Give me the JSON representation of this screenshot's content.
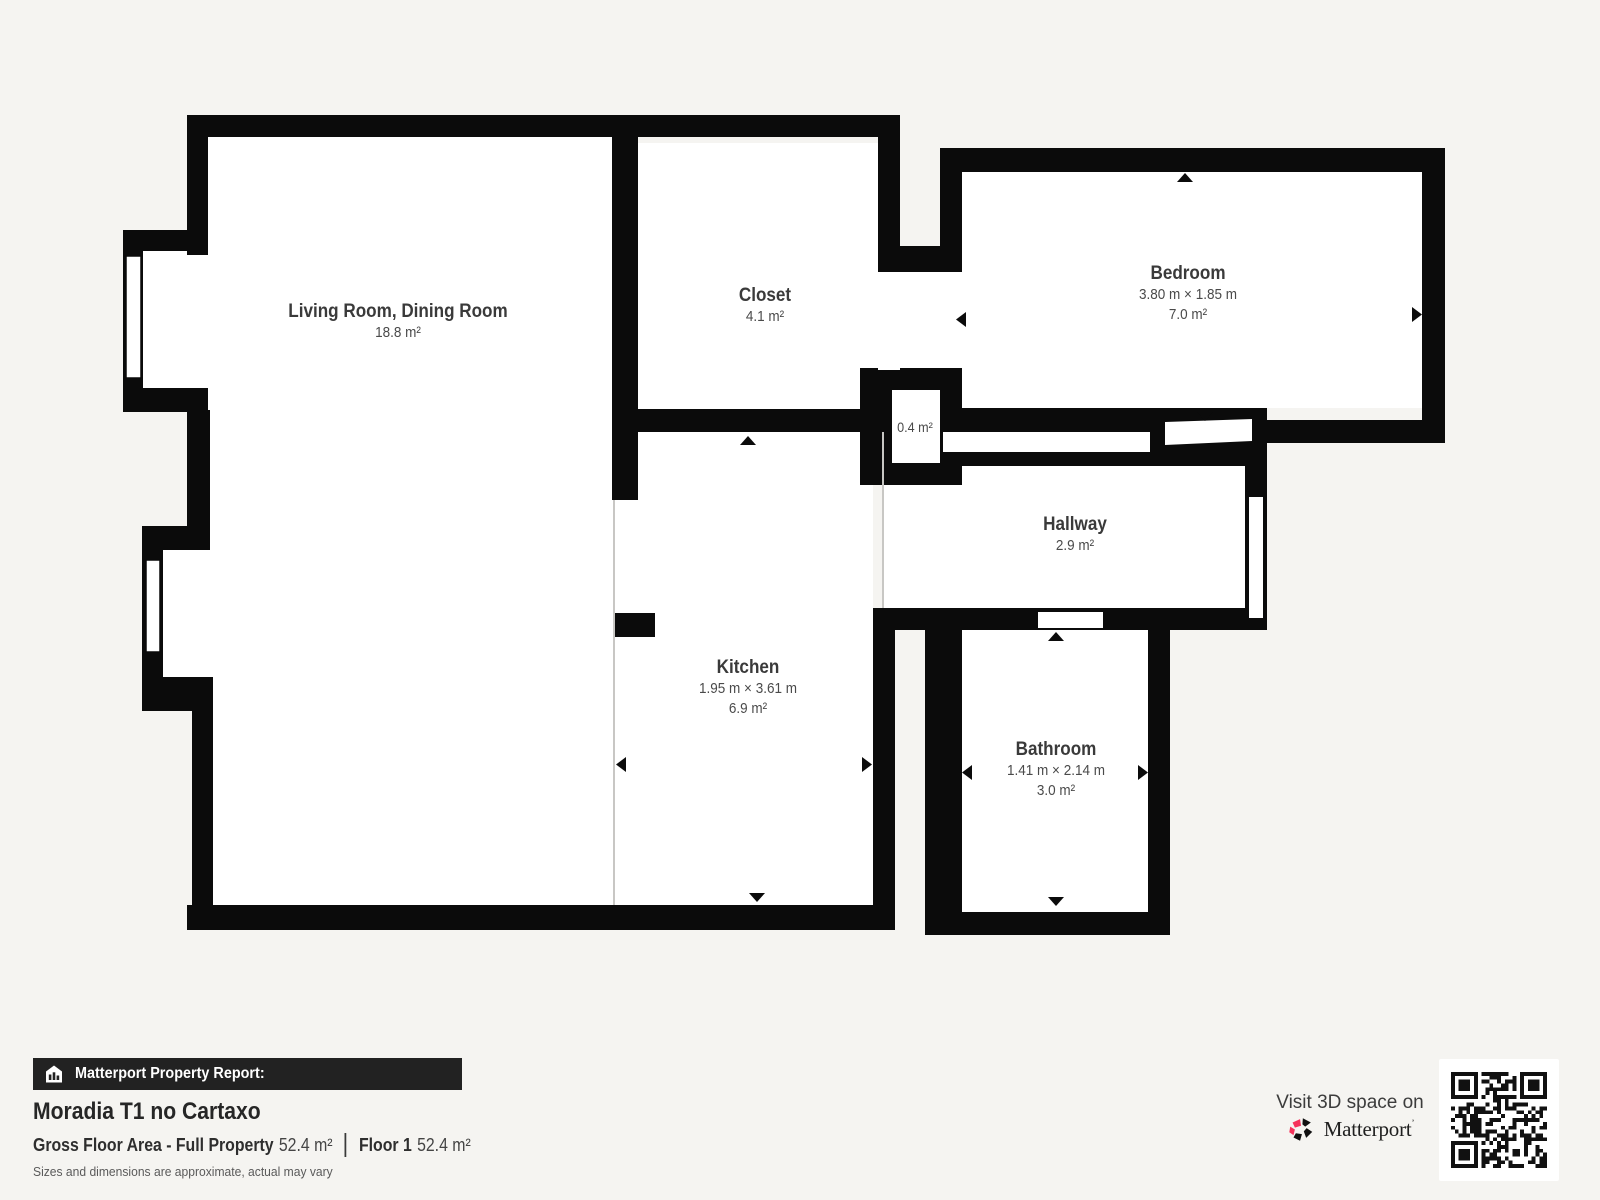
{
  "floor_plan": {
    "rooms": [
      {
        "id": "living",
        "name": "Living Room, Dining Room",
        "dims": "",
        "area": "18.8 m²"
      },
      {
        "id": "closet",
        "name": "Closet",
        "dims": "",
        "area": "4.1 m²"
      },
      {
        "id": "bedroom",
        "name": "Bedroom",
        "dims": "3.80 m × 1.85 m",
        "area": "7.0 m²"
      },
      {
        "id": "small_closet",
        "name": "",
        "dims": "",
        "area": "0.4 m²"
      },
      {
        "id": "hallway",
        "name": "Hallway",
        "dims": "",
        "area": "2.9 m²"
      },
      {
        "id": "kitchen",
        "name": "Kitchen",
        "dims": "1.95 m × 3.61 m",
        "area": "6.9 m²"
      },
      {
        "id": "bathroom",
        "name": "Bathroom",
        "dims": "1.41 m × 2.14 m",
        "area": "3.0 m²"
      }
    ]
  },
  "report": {
    "bar_label": "Matterport Property Report:",
    "property_name": "Moradia T1 no Cartaxo",
    "gross_label": "Gross Floor Area - Full Property",
    "gross_value": "52.4 m²",
    "floor_label": "Floor 1",
    "floor_value": "52.4 m²",
    "disclaimer": "Sizes and dimensions are approximate, actual may vary"
  },
  "promo": {
    "visit_text": "Visit 3D space on",
    "brand": "Matterport",
    "brand_mark": "’"
  },
  "colors": {
    "background": "#f5f4f1",
    "wall": "#0b0b0b",
    "room_fill": "#ffffff",
    "open_boundary_line": "#c8c7c4",
    "accent_pink": "#f5325b",
    "bar_bg": "#222222"
  }
}
